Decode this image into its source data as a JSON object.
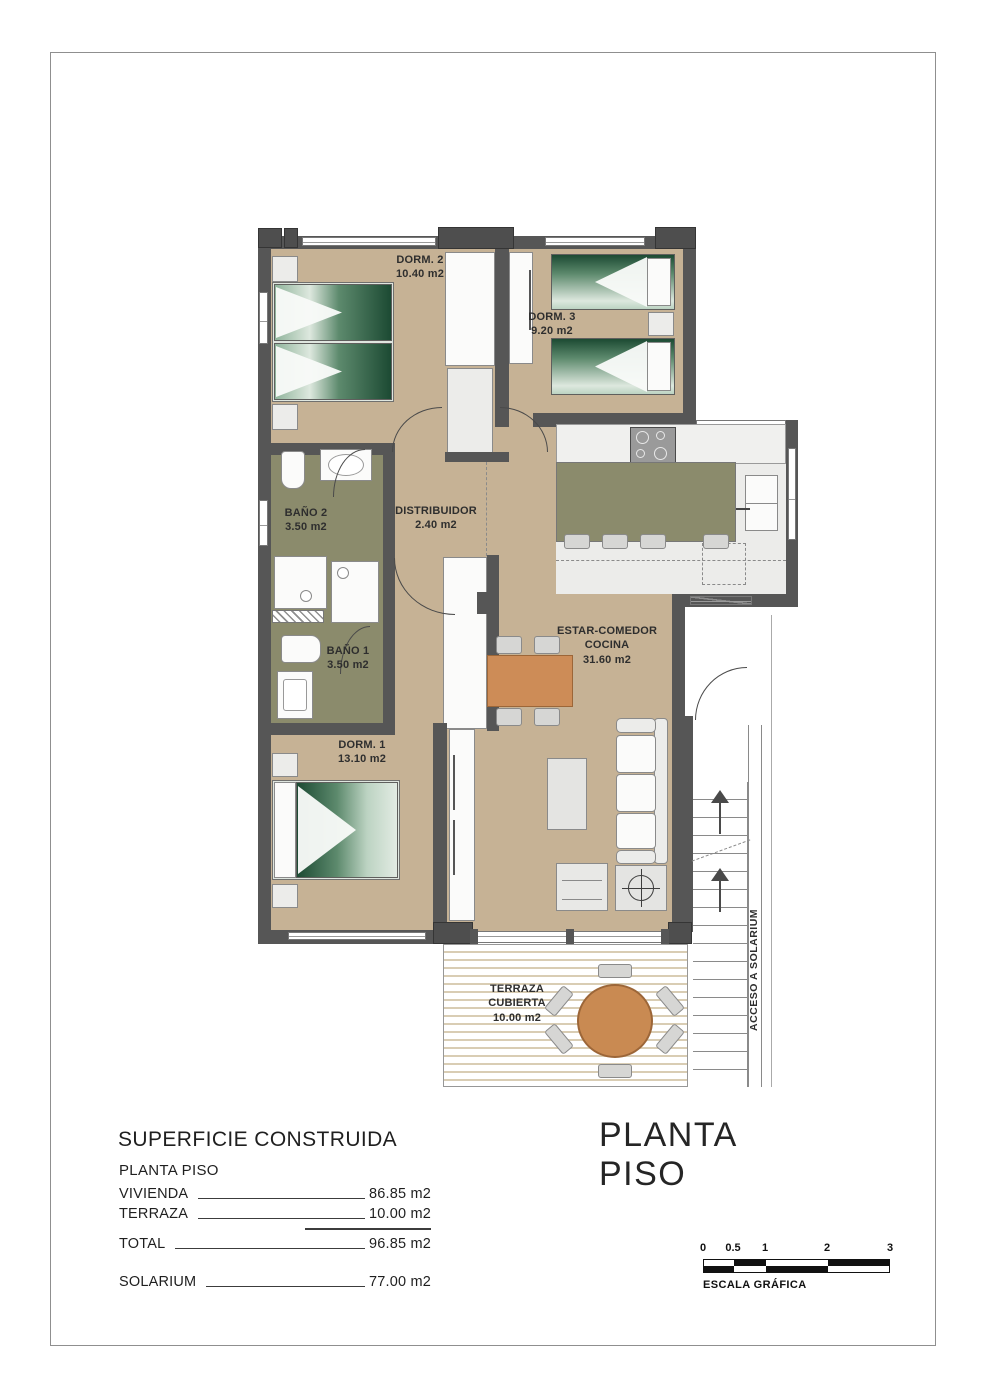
{
  "plan": {
    "rooms": {
      "dorm2": {
        "name": "DORM. 2",
        "area": "10.40 m2"
      },
      "dorm3": {
        "name": "DORM. 3",
        "area": "9.20 m2"
      },
      "bano2": {
        "name": "BAÑO 2",
        "area": "3.50 m2"
      },
      "distribuidor": {
        "name": "DISTRIBUIDOR",
        "area": "2.40 m2"
      },
      "bano1": {
        "name": "BAÑO 1",
        "area": "3.50 m2"
      },
      "estar": {
        "name": "ESTAR-COMEDOR",
        "name2": "COCINA",
        "area": "31.60 m2"
      },
      "dorm1": {
        "name": "DORM. 1",
        "area": "13.10 m2"
      },
      "terraza": {
        "name": "TERRAZA",
        "name2": "CUBIERTA",
        "area": "10.00 m2"
      }
    },
    "stairs_label": "ACCESO A SOLARIUM"
  },
  "summary": {
    "title": "SUPERFICIE CONSTRUIDA",
    "subtitle": "PLANTA PISO",
    "rows": [
      {
        "label": "VIVIENDA",
        "value": "86.85 m2"
      },
      {
        "label": "TERRAZA",
        "value": "10.00 m2"
      },
      {
        "label": "TOTAL",
        "value": "96.85 m2"
      },
      {
        "label": "SOLARIUM",
        "value": "77.00 m2"
      }
    ]
  },
  "drawing": {
    "title": "PLANTA PISO"
  },
  "scale_bar": {
    "ticks": [
      "0",
      "0.5",
      "1",
      "2",
      "3"
    ],
    "caption": "ESCALA GRÁFICA"
  },
  "colors": {
    "wall": "#565656",
    "floor": "#c6b295",
    "wet_room_floor": "#8b8b6c",
    "kitchen_floor": "#ececea",
    "wood_accent": "#cd8c57",
    "bed_green": "#1c4a33",
    "deck_stripe": "#d9cdb4"
  }
}
